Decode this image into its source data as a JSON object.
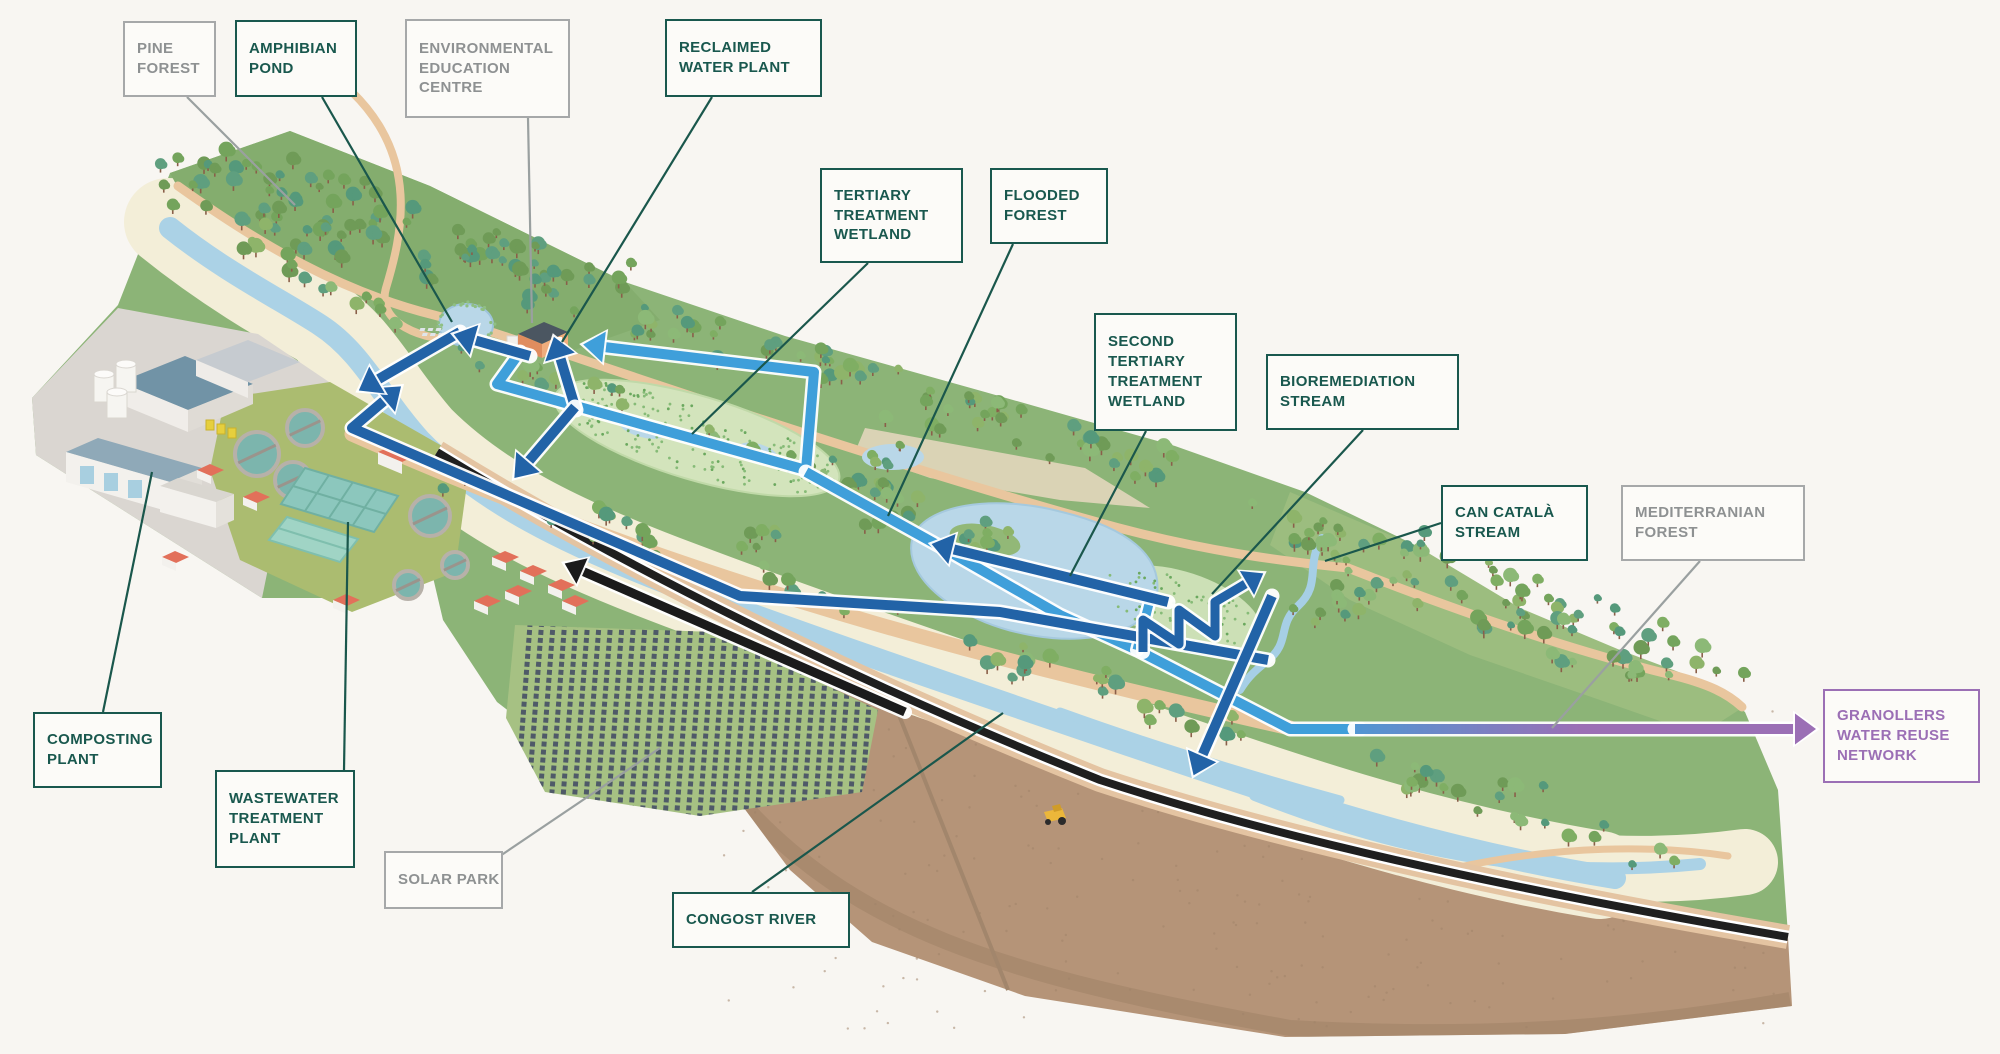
{
  "diagram_type": "isometric environmental park water-reuse infographic",
  "labels": [
    {
      "id": "pine-forest",
      "text": "PINE FOREST",
      "style": "gray"
    },
    {
      "id": "amphibian-pond",
      "text": "AMPHIBIAN POND",
      "style": "teal"
    },
    {
      "id": "environmental-education-centre",
      "text": "ENVIRONMENTAL EDUCATION CENTRE",
      "style": "gray"
    },
    {
      "id": "reclaimed-water-plant",
      "text": "RECLAIMED WATER PLANT",
      "style": "teal"
    },
    {
      "id": "tertiary-treatment-wetland",
      "text": "TERTIARY TREATMENT WETLAND",
      "style": "teal"
    },
    {
      "id": "flooded-forest",
      "text": "FLOODED FOREST",
      "style": "teal"
    },
    {
      "id": "second-tertiary-treatment-wetland",
      "text": "SECOND TERTIARY TREATMENT WETLAND",
      "style": "teal"
    },
    {
      "id": "bioremediation-stream",
      "text": "BIOREMEDIATION STREAM",
      "style": "teal"
    },
    {
      "id": "can-catala-stream",
      "text": "CAN CATALÀ STREAM",
      "style": "teal"
    },
    {
      "id": "mediterranean-forest",
      "text": "MEDITERRANIAN FOREST",
      "style": "gray"
    },
    {
      "id": "granollers-water-reuse-network",
      "text": "GRANOLLERS WATER REUSE NETWORK",
      "style": "purple"
    },
    {
      "id": "composting-plant",
      "text": "COMPOSTING PLANT",
      "style": "teal"
    },
    {
      "id": "wastewater-treatment-plant",
      "text": "WASTEWATER TREATMENT PLANT",
      "style": "teal"
    },
    {
      "id": "solar-park",
      "text": "SOLAR PARK",
      "style": "gray"
    },
    {
      "id": "congost-river",
      "text": "CONGOST RIVER",
      "style": "teal"
    }
  ],
  "flows": [
    {
      "name": "treated-water-flow-arrow",
      "color": "#2263a7"
    },
    {
      "name": "reclaimed-water-loop-arrow",
      "color": "#3f9fda"
    },
    {
      "name": "road-transport-arrow",
      "color": "#1b1b1b"
    },
    {
      "name": "reuse-network-export-arrow",
      "color": "#9b6fb5"
    }
  ],
  "colors": {
    "background": "#f8f6f2",
    "label_teal": "#19584e",
    "label_gray": "#8e9192",
    "label_purple": "#9b6fb5",
    "flow_dark_blue": "#2263a7",
    "flow_light_blue": "#3f9fda",
    "flow_black": "#1b1b1b",
    "flow_purple": "#9b6fb5",
    "park_green": "#8cb477",
    "river_blue": "#abd2e6",
    "pond_blue": "#b9d7e8",
    "farmland_brown": "#b59478",
    "path_tan": "#e9c69e"
  }
}
